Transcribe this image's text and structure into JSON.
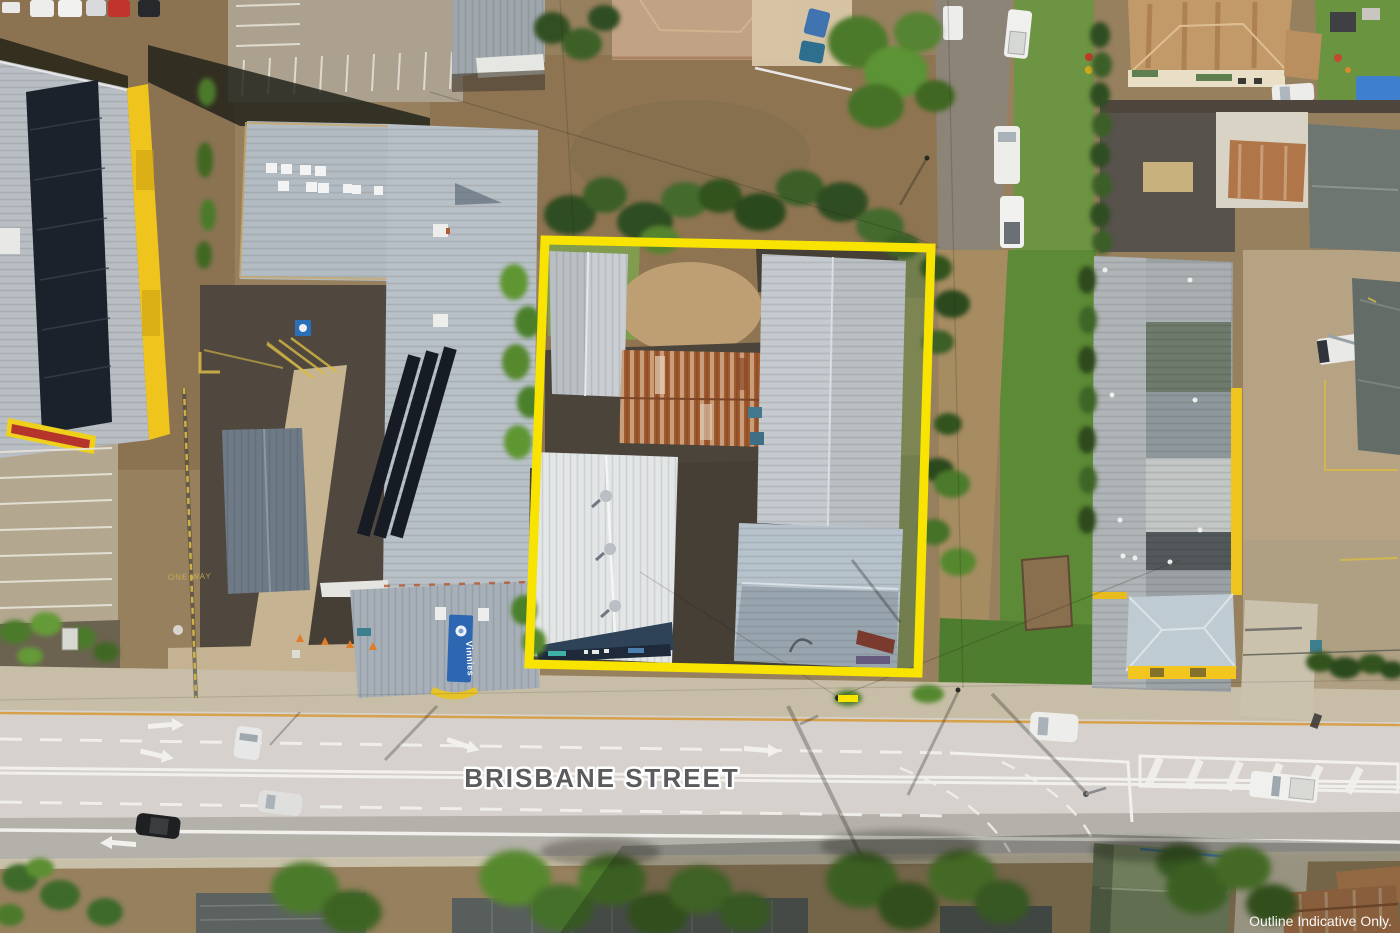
{
  "annotations": {
    "street_label": "BRISBANE STREET",
    "disclaimer": "Outline Indicative Only.",
    "outline_color": "#F8E400",
    "street_label_color": "#5B5B5E",
    "disclaimer_color": "#FFFFFF"
  },
  "signage": {
    "vinnies_banner": "Vinnies",
    "vinnies_banner_color": "#2E67B1",
    "one_way_marking": "ONE WAY"
  }
}
